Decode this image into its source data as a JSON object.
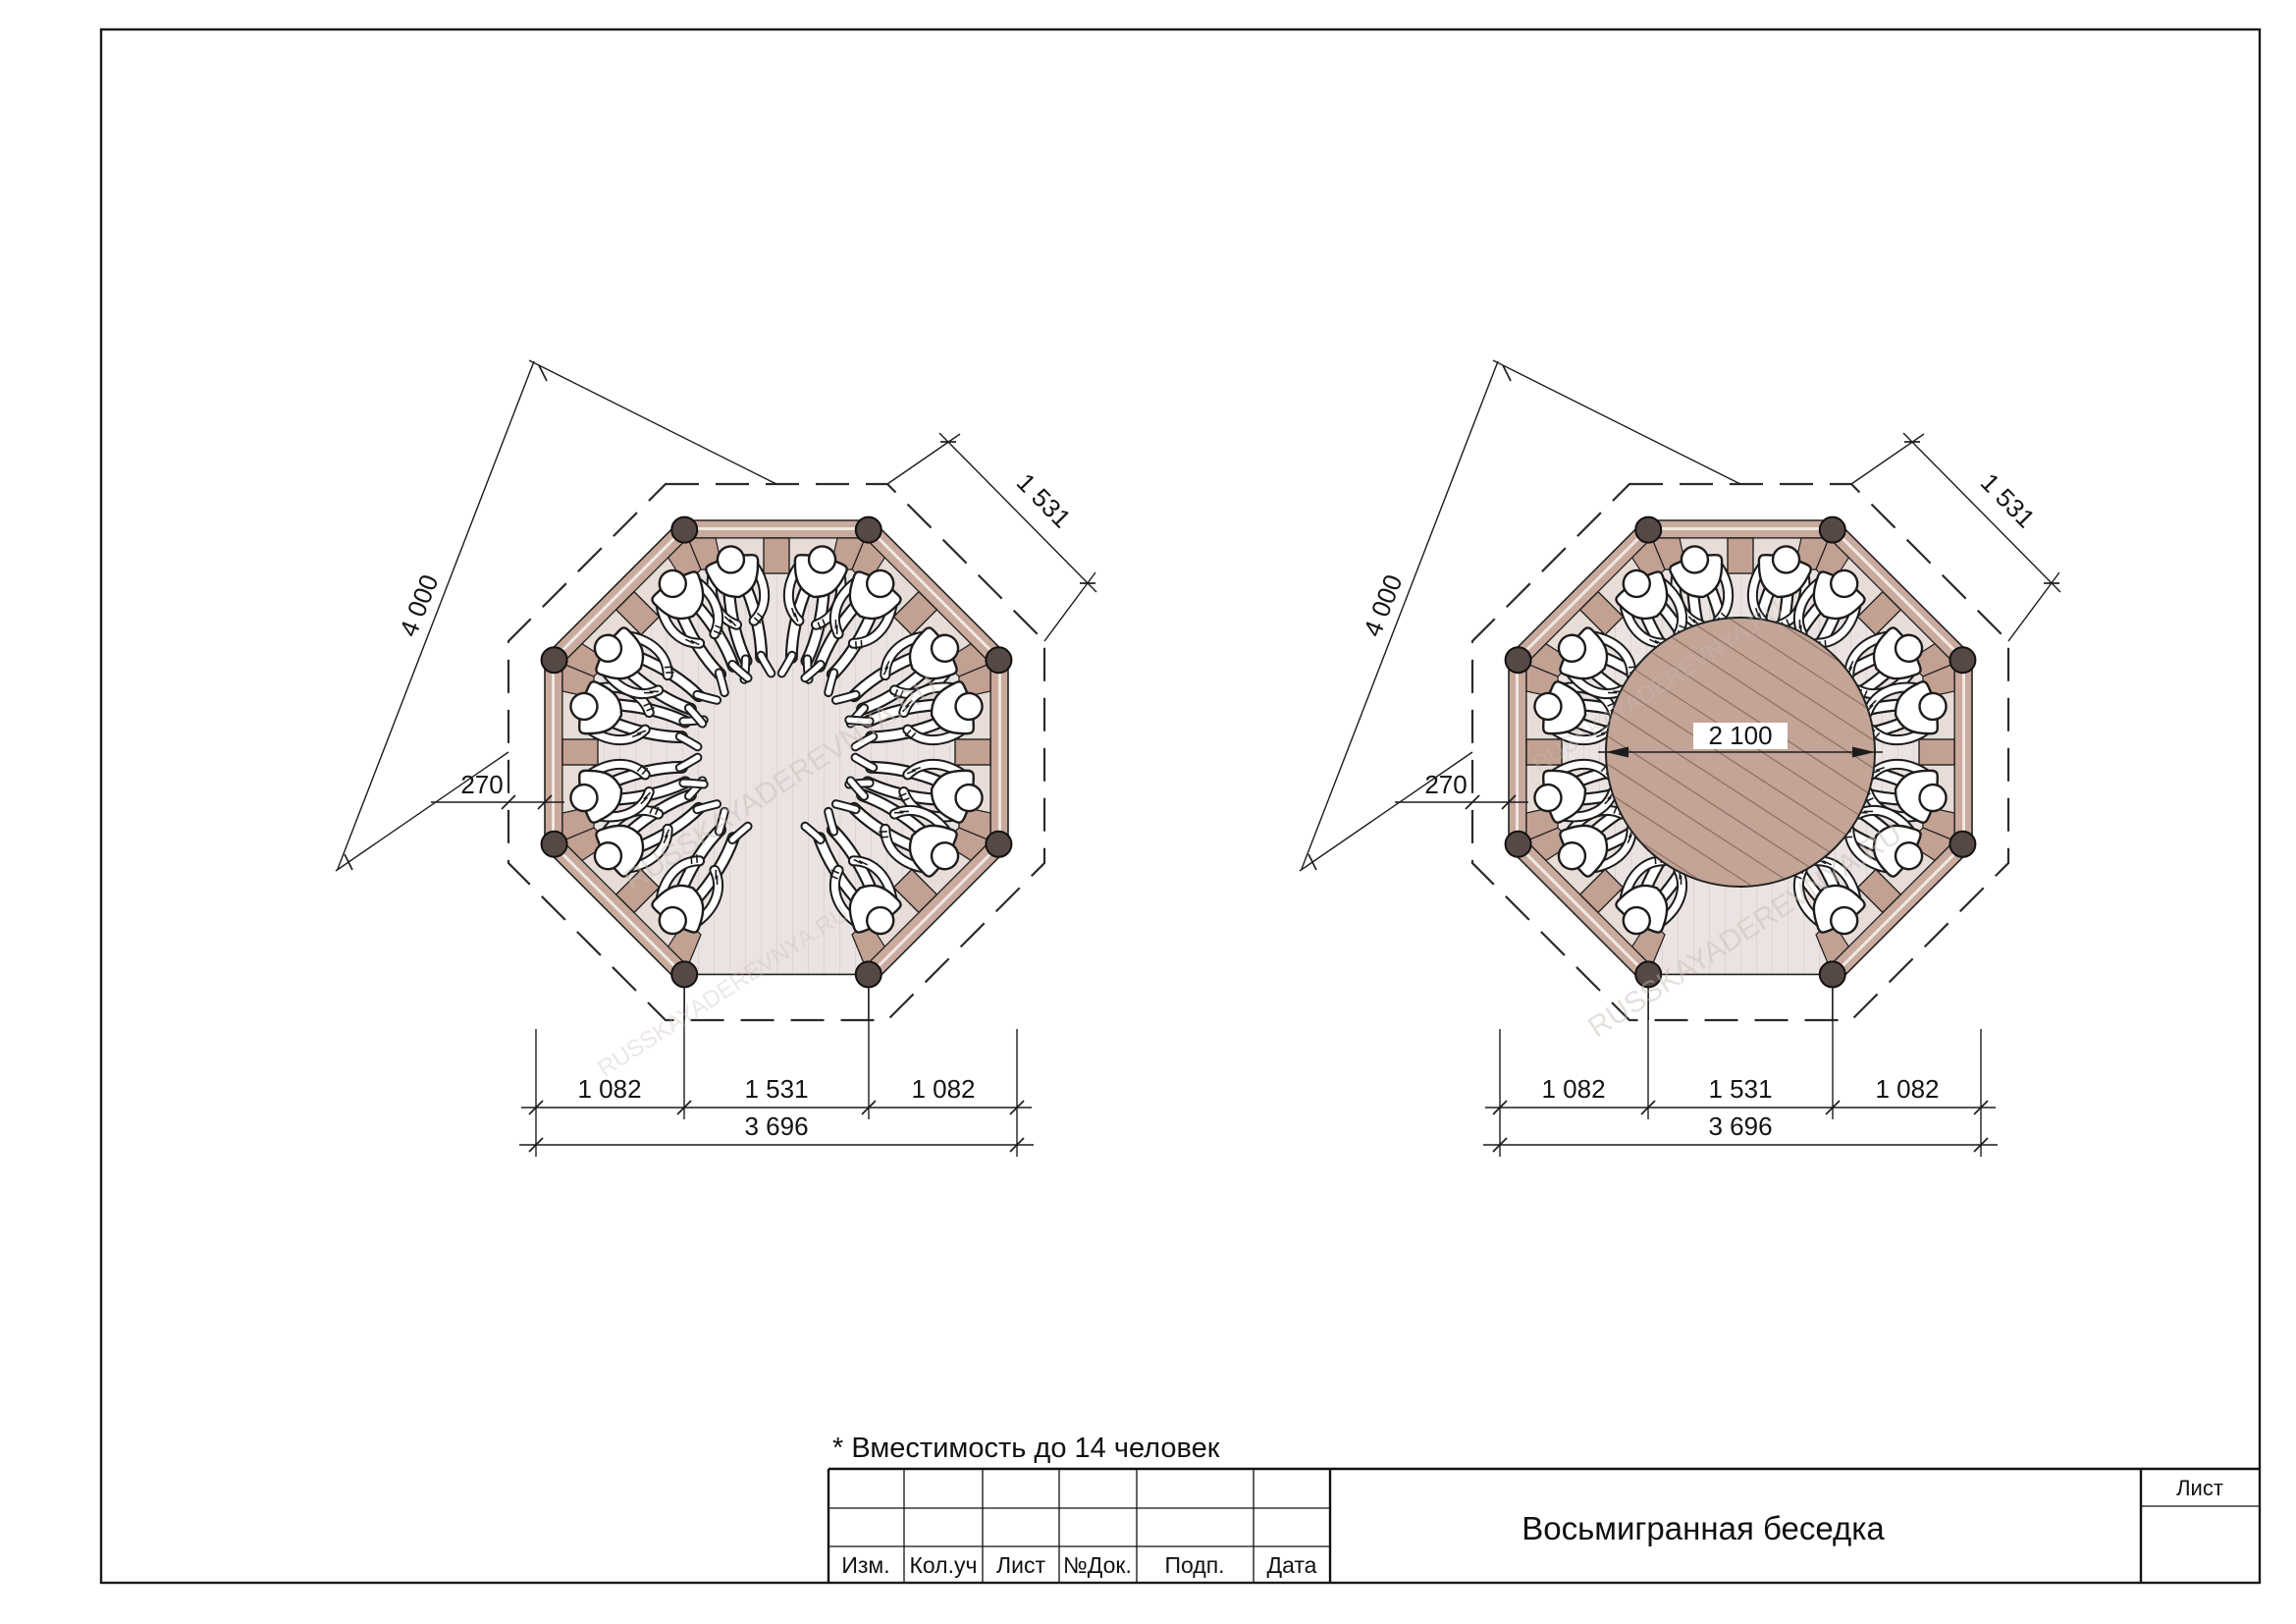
{
  "note": {
    "text": "* Вместимость до 14 человек"
  },
  "title_block": {
    "document_title": "Восьмигранная беседка",
    "sheet_label": "Лист",
    "col_izm": "Изм.",
    "col_koluch": "Кол.уч",
    "col_list": "Лист",
    "col_ndok": "№Док.",
    "col_podp": "Подп.",
    "col_data": "Дата"
  },
  "dims": {
    "overall_diagonal": "4 000",
    "roof_edge": "1 531",
    "eaves_offset": "270",
    "side_segment": "1 082",
    "entrance_width": "1 531",
    "total_width": "3 696",
    "table_diameter": "2 100"
  },
  "plans": {
    "left_label": "octagonal gazebo plan - open floor",
    "right_label": "octagonal gazebo plan - with round table"
  },
  "watermark": {
    "text": "RUSSKAYADEREVNYA.RU"
  },
  "colors": {
    "wall": "#c9aa9c",
    "bench": "#e7dcd6",
    "bench_block": "#c2a092",
    "post": "#554845",
    "floor": "#eae3e1",
    "floor_stripe": "#dcd0ca",
    "table": "#c3a496",
    "table_hatch": "#8f7569",
    "line": "#1c1c1c"
  }
}
